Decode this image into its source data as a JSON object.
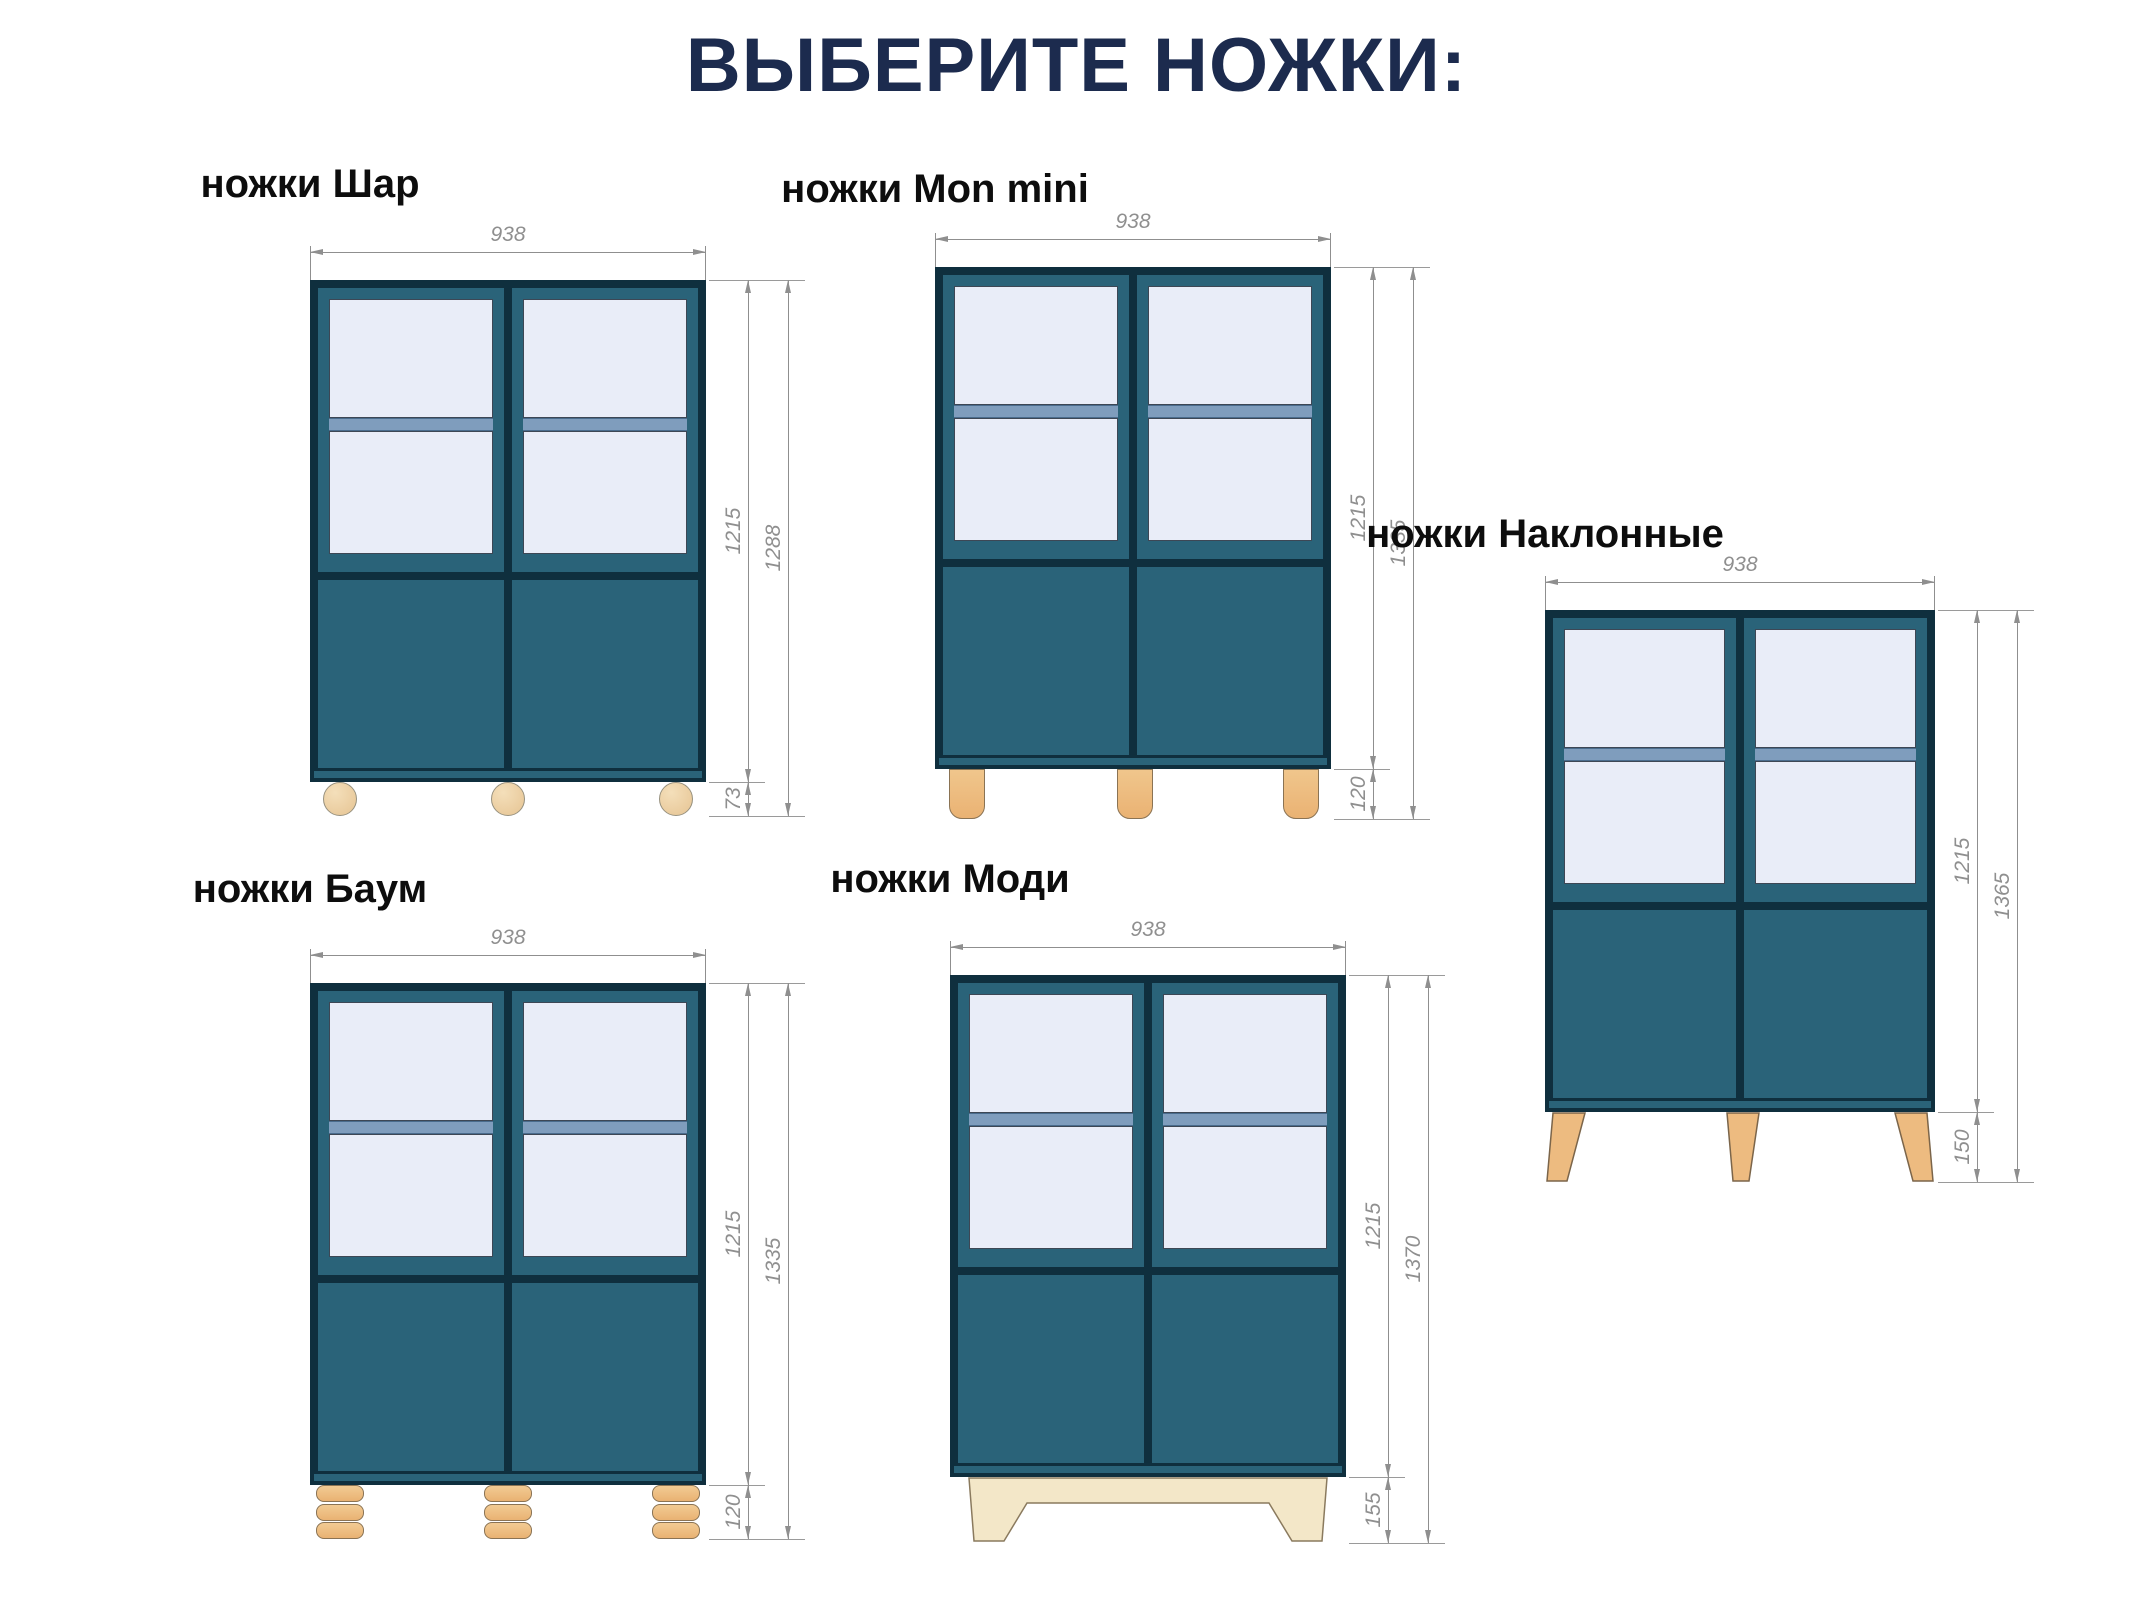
{
  "title": "ВЫБЕРИТЕ НОЖКИ:",
  "colors": {
    "title_navy": "#1c2b4e",
    "label_black": "#0d0d0d",
    "cabinet_teal": "#2a6379",
    "cabinet_outline": "#0f2f3e",
    "glass": "#e9edf8",
    "shelf_blue": "#7f9dbd",
    "leg_wood": "#eab273",
    "plinth_plywood": "#f3e7c8",
    "dimension_gray": "#8f8f8f"
  },
  "cabinets": [
    {
      "id": "shar",
      "title": "ножки Шар",
      "leg_type": "ball-legs",
      "width": "938",
      "body_height": "1215",
      "total_height": "1288",
      "leg_height": "73"
    },
    {
      "id": "mon-mini",
      "title": "ножки Mon mini",
      "leg_type": "straight-cylinder-legs",
      "width": "938",
      "body_height": "1215",
      "total_height": "1335",
      "leg_height": "120"
    },
    {
      "id": "naklonnye",
      "title": "ножки Наклонные",
      "leg_type": "slanted-tapered-legs",
      "width": "938",
      "body_height": "1215",
      "total_height": "1365",
      "leg_height": "150"
    },
    {
      "id": "baum",
      "title": "ножки Баум",
      "leg_type": "stacked-disc-legs",
      "width": "938",
      "body_height": "1215",
      "total_height": "1335",
      "leg_height": "120"
    },
    {
      "id": "modi",
      "title": "ножки Моди",
      "leg_type": "plinth-base",
      "width": "938",
      "body_height": "1215",
      "total_height": "1370",
      "leg_height": "155"
    }
  ]
}
